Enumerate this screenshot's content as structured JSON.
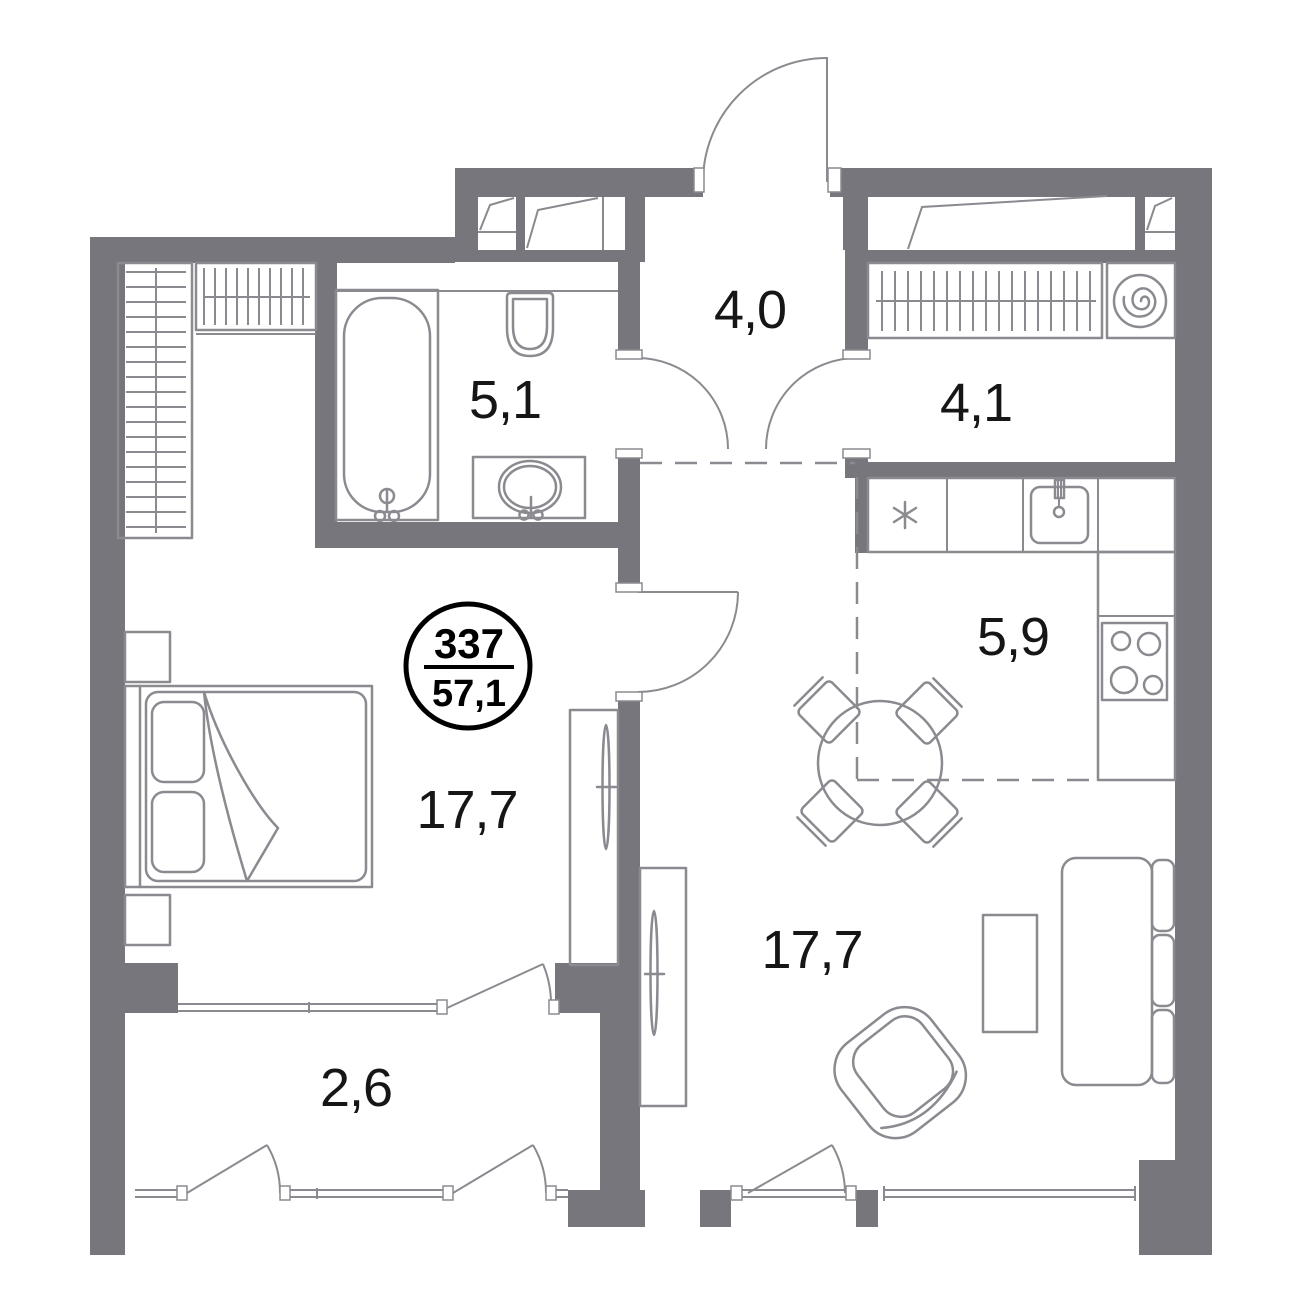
{
  "meta": {
    "type": "apartment-floor-plan"
  },
  "badge": {
    "unit": "337",
    "area": "57,1"
  },
  "rooms": [
    {
      "name": "hallway",
      "area": "4,0"
    },
    {
      "name": "bathroom",
      "area": "5,1"
    },
    {
      "name": "storage",
      "area": "4,1"
    },
    {
      "name": "kitchen",
      "area": "5,9"
    },
    {
      "name": "bedroom",
      "area": "17,7"
    },
    {
      "name": "living-room",
      "area": "17,7"
    },
    {
      "name": "balcony",
      "area": "2,6"
    }
  ],
  "colors": {
    "wall": "#77767C",
    "line": "#8B8A90",
    "text": "#161616",
    "badge_stroke": "#000000"
  },
  "furniture": [
    "bed",
    "nightstand",
    "closet-shelves",
    "closet-rail",
    "bathtub",
    "toilet",
    "vanity-sink",
    "washing-machine",
    "kitchen-counter",
    "kitchen-sink",
    "stove",
    "dining-table",
    "dining-chair",
    "sofa",
    "coffee-table",
    "armchair",
    "sliding-wardrobe"
  ]
}
